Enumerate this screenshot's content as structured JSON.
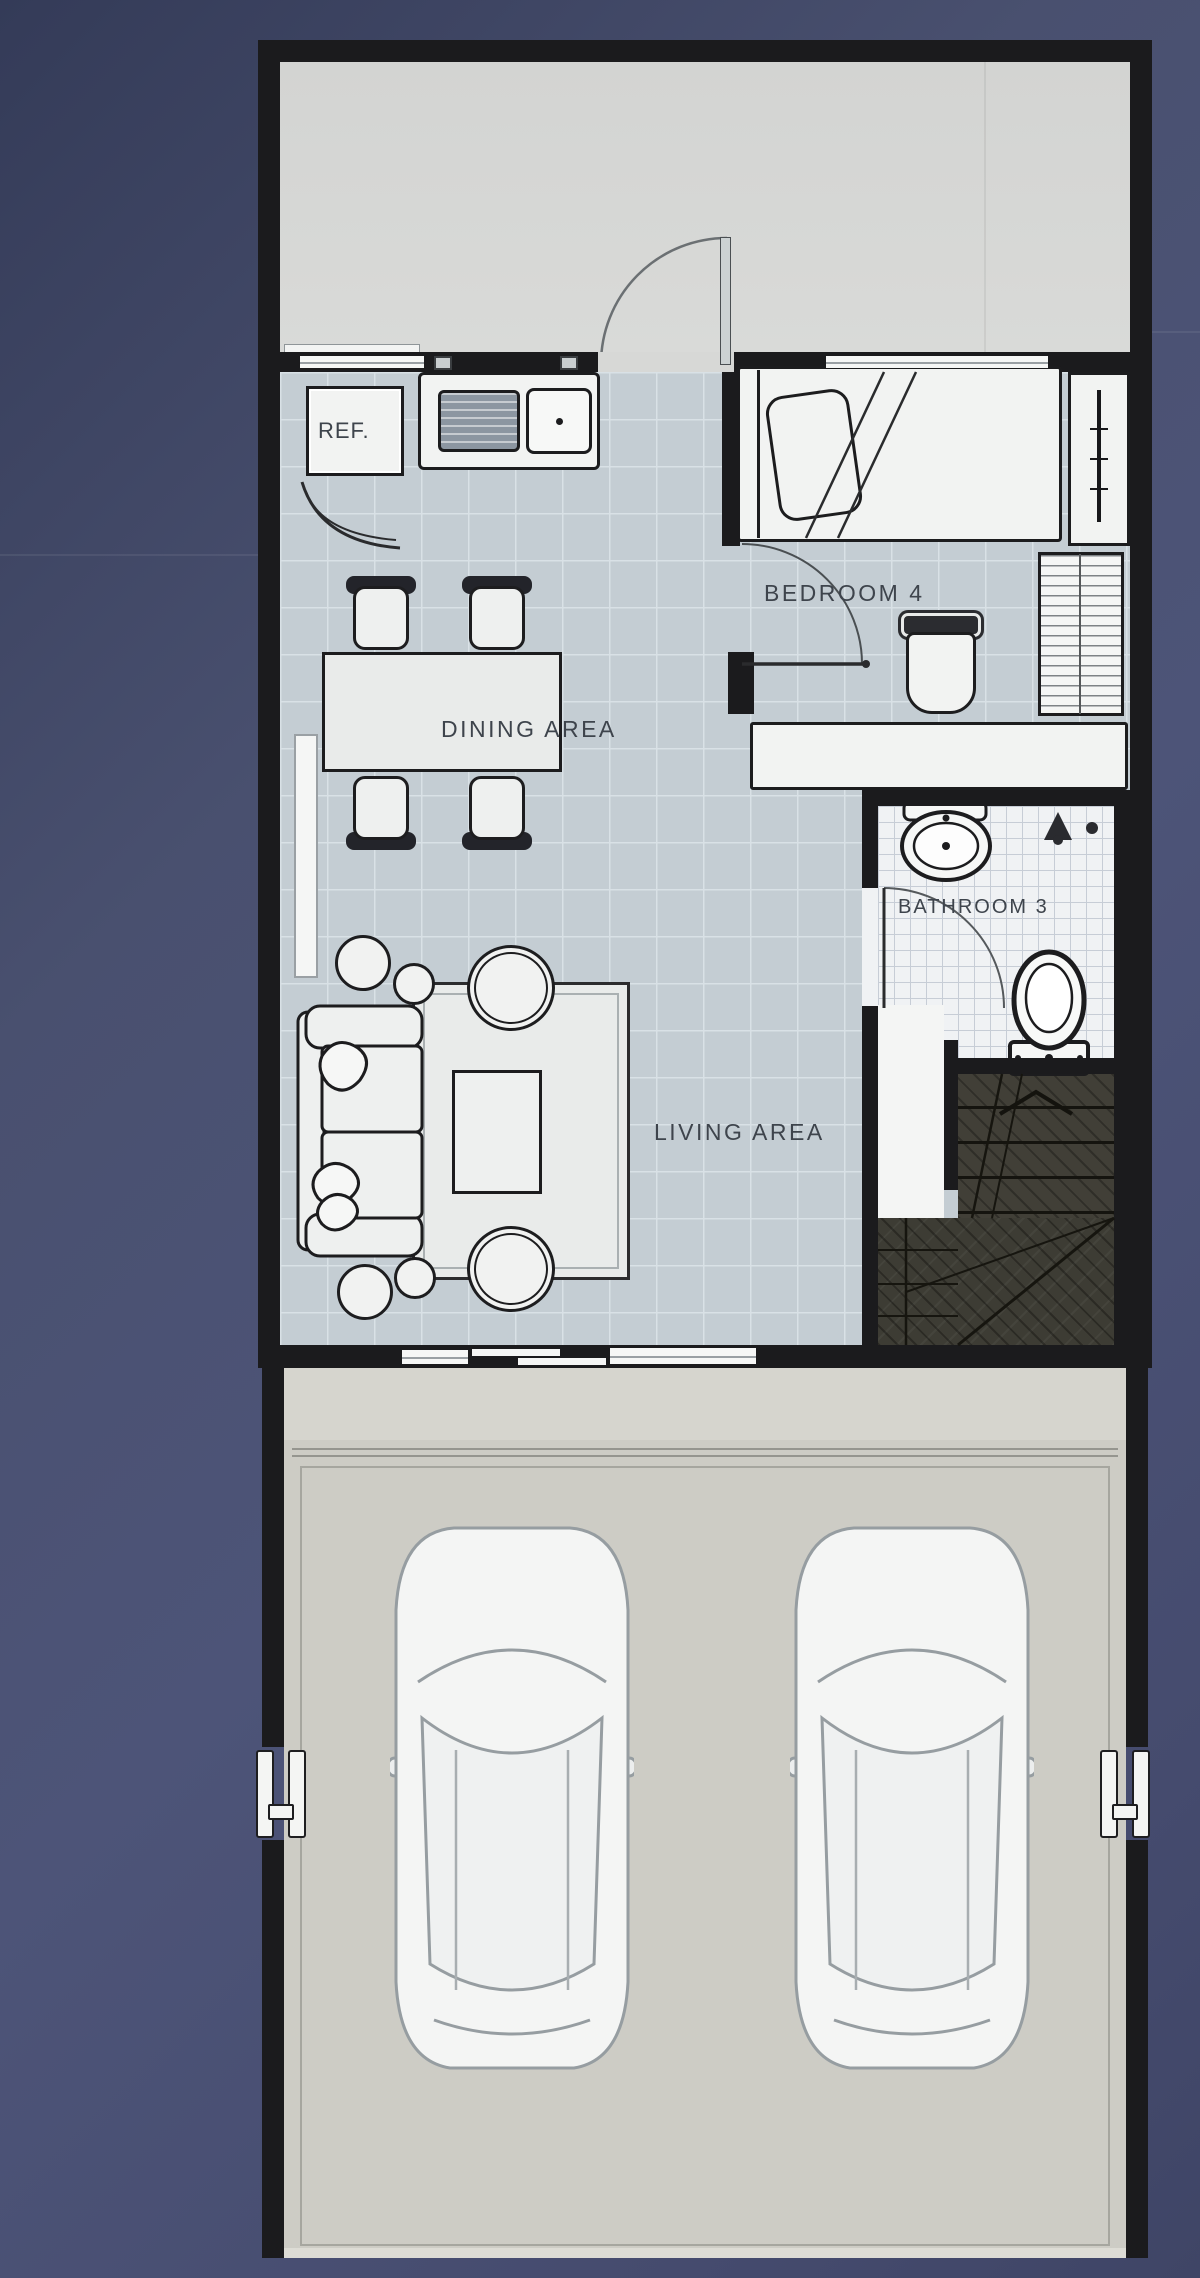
{
  "plan": {
    "type": "floor-plan",
    "rooms": {
      "dining": {
        "label": "DINING AREA"
      },
      "living": {
        "label": "LIVING AREA"
      },
      "bedroom": {
        "label": "BEDROOM 4"
      },
      "bathroom": {
        "label": "BATHROOM 3"
      },
      "refrigerator": {
        "label": "REF."
      }
    },
    "features": [
      "entry-patio",
      "kitchen-sink",
      "dining-set",
      "sofa-set",
      "stairs",
      "corridor",
      "two-car-garage",
      "driveway",
      "gate-markers"
    ],
    "colors": {
      "background": "#4a5172",
      "wall": "#1b1b1d",
      "floor": "#c4cdd3",
      "patio": "#d7d8d6",
      "garage_floor": "#cdccc5",
      "stairs": "#3f3e37",
      "bath_tile": "#f0f2f4",
      "furniture": "#f2f3f2",
      "label_text": "#3e444c"
    }
  }
}
